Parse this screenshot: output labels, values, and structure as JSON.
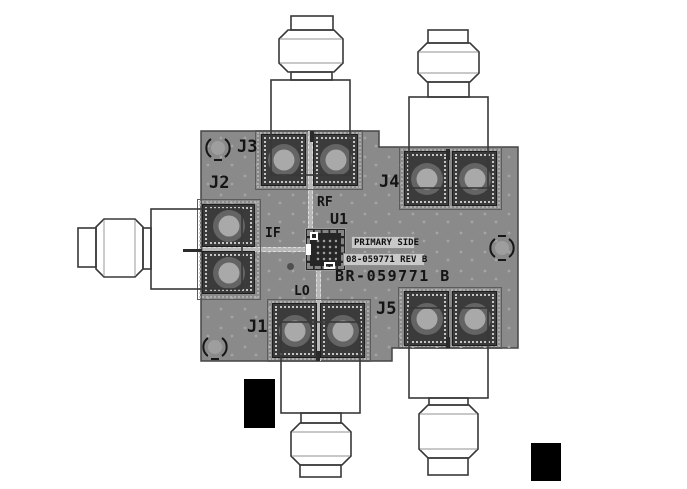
{
  "drawing": {
    "title": "PCB evaluation board assembly drawing",
    "board_name": "BR-059771 B",
    "primary_side_label": "PRIMARY SIDE",
    "part_number_label": "08-059771 REV B",
    "chip_refdes": "U1",
    "connectors": {
      "j1": "J1",
      "j2": "J2",
      "j3": "J3",
      "j4": "J4",
      "j5": "J5"
    },
    "signals": {
      "rf": "RF",
      "if": "IF",
      "lo": "LO"
    },
    "colors": {
      "background": "#ffffff",
      "board": "#8a8a8a",
      "board_outline": "#454545",
      "pad_dark": "#3b3b3b",
      "via_dot": "#a4a4a4",
      "pad_ring": "#646464",
      "pad_hole": "#a9a9a9",
      "trace": "#b8b8b8",
      "silkscreen": "#141414",
      "label_bg": "#c9c9c9",
      "connector_outline": "#383838",
      "redaction": "#000000"
    }
  }
}
